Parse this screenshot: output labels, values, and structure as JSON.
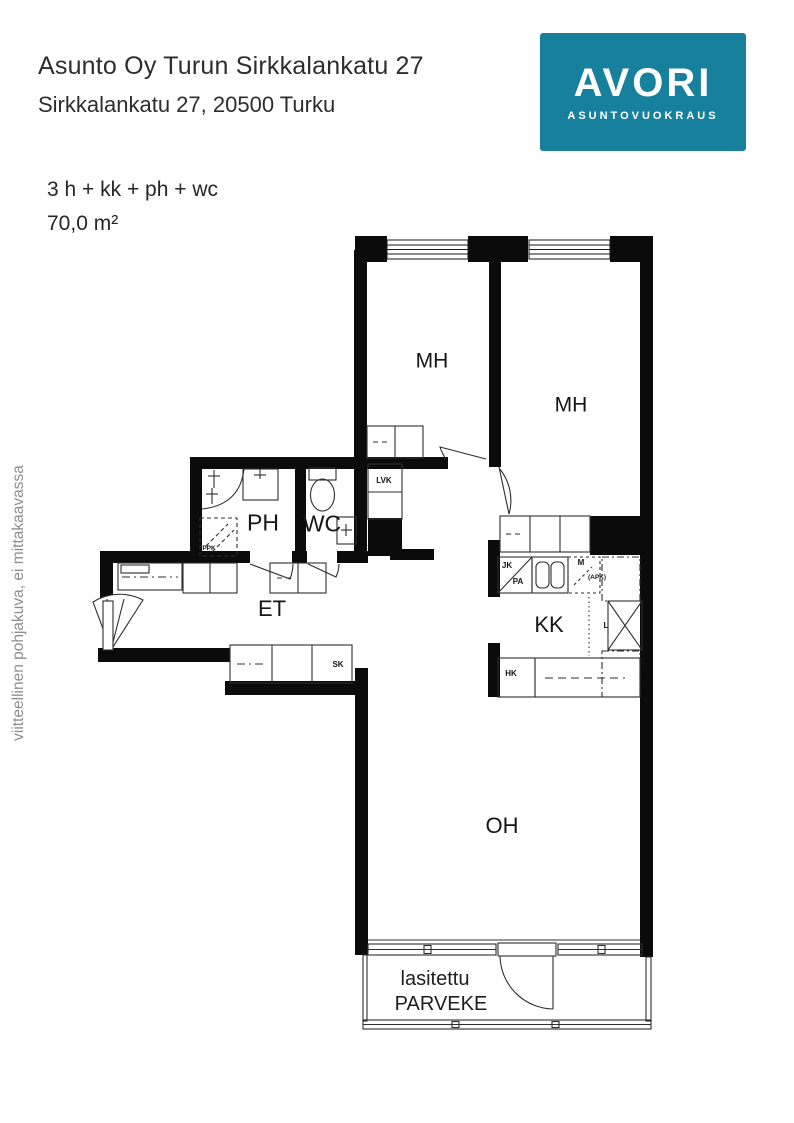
{
  "header": {
    "title": "Asunto Oy Turun Sirkkalankatu 27",
    "subtitle": "Sirkkalankatu 27, 20500 Turku"
  },
  "logo": {
    "brand": "AVORI",
    "tagline": "ASUNTOVUOKRAUS"
  },
  "details": {
    "rooms": "3 h + kk + ph + wc",
    "area": "70,0 m²"
  },
  "watermark": "viitteellinen pohjakuva, ei mittakaavassa",
  "colors": {
    "brand": "#17809d",
    "wall": "#0b0b0b",
    "watermark": "#8e8e8e"
  },
  "floorplan": {
    "rooms": {
      "mh1": "MH",
      "mh2": "MH",
      "ph": "PH",
      "wc": "WC",
      "et": "ET",
      "kk": "KK",
      "oh": "OH",
      "balcony_line1": "lasitettu",
      "balcony_line2": "PARVEKE"
    },
    "fixtures": {
      "lvk": "LVK",
      "ppk": "PPK",
      "sk": "SK",
      "jk": "JK",
      "pa": "PA",
      "m": "M",
      "apk": "(APK)",
      "hk": "HK",
      "l": "L"
    }
  }
}
